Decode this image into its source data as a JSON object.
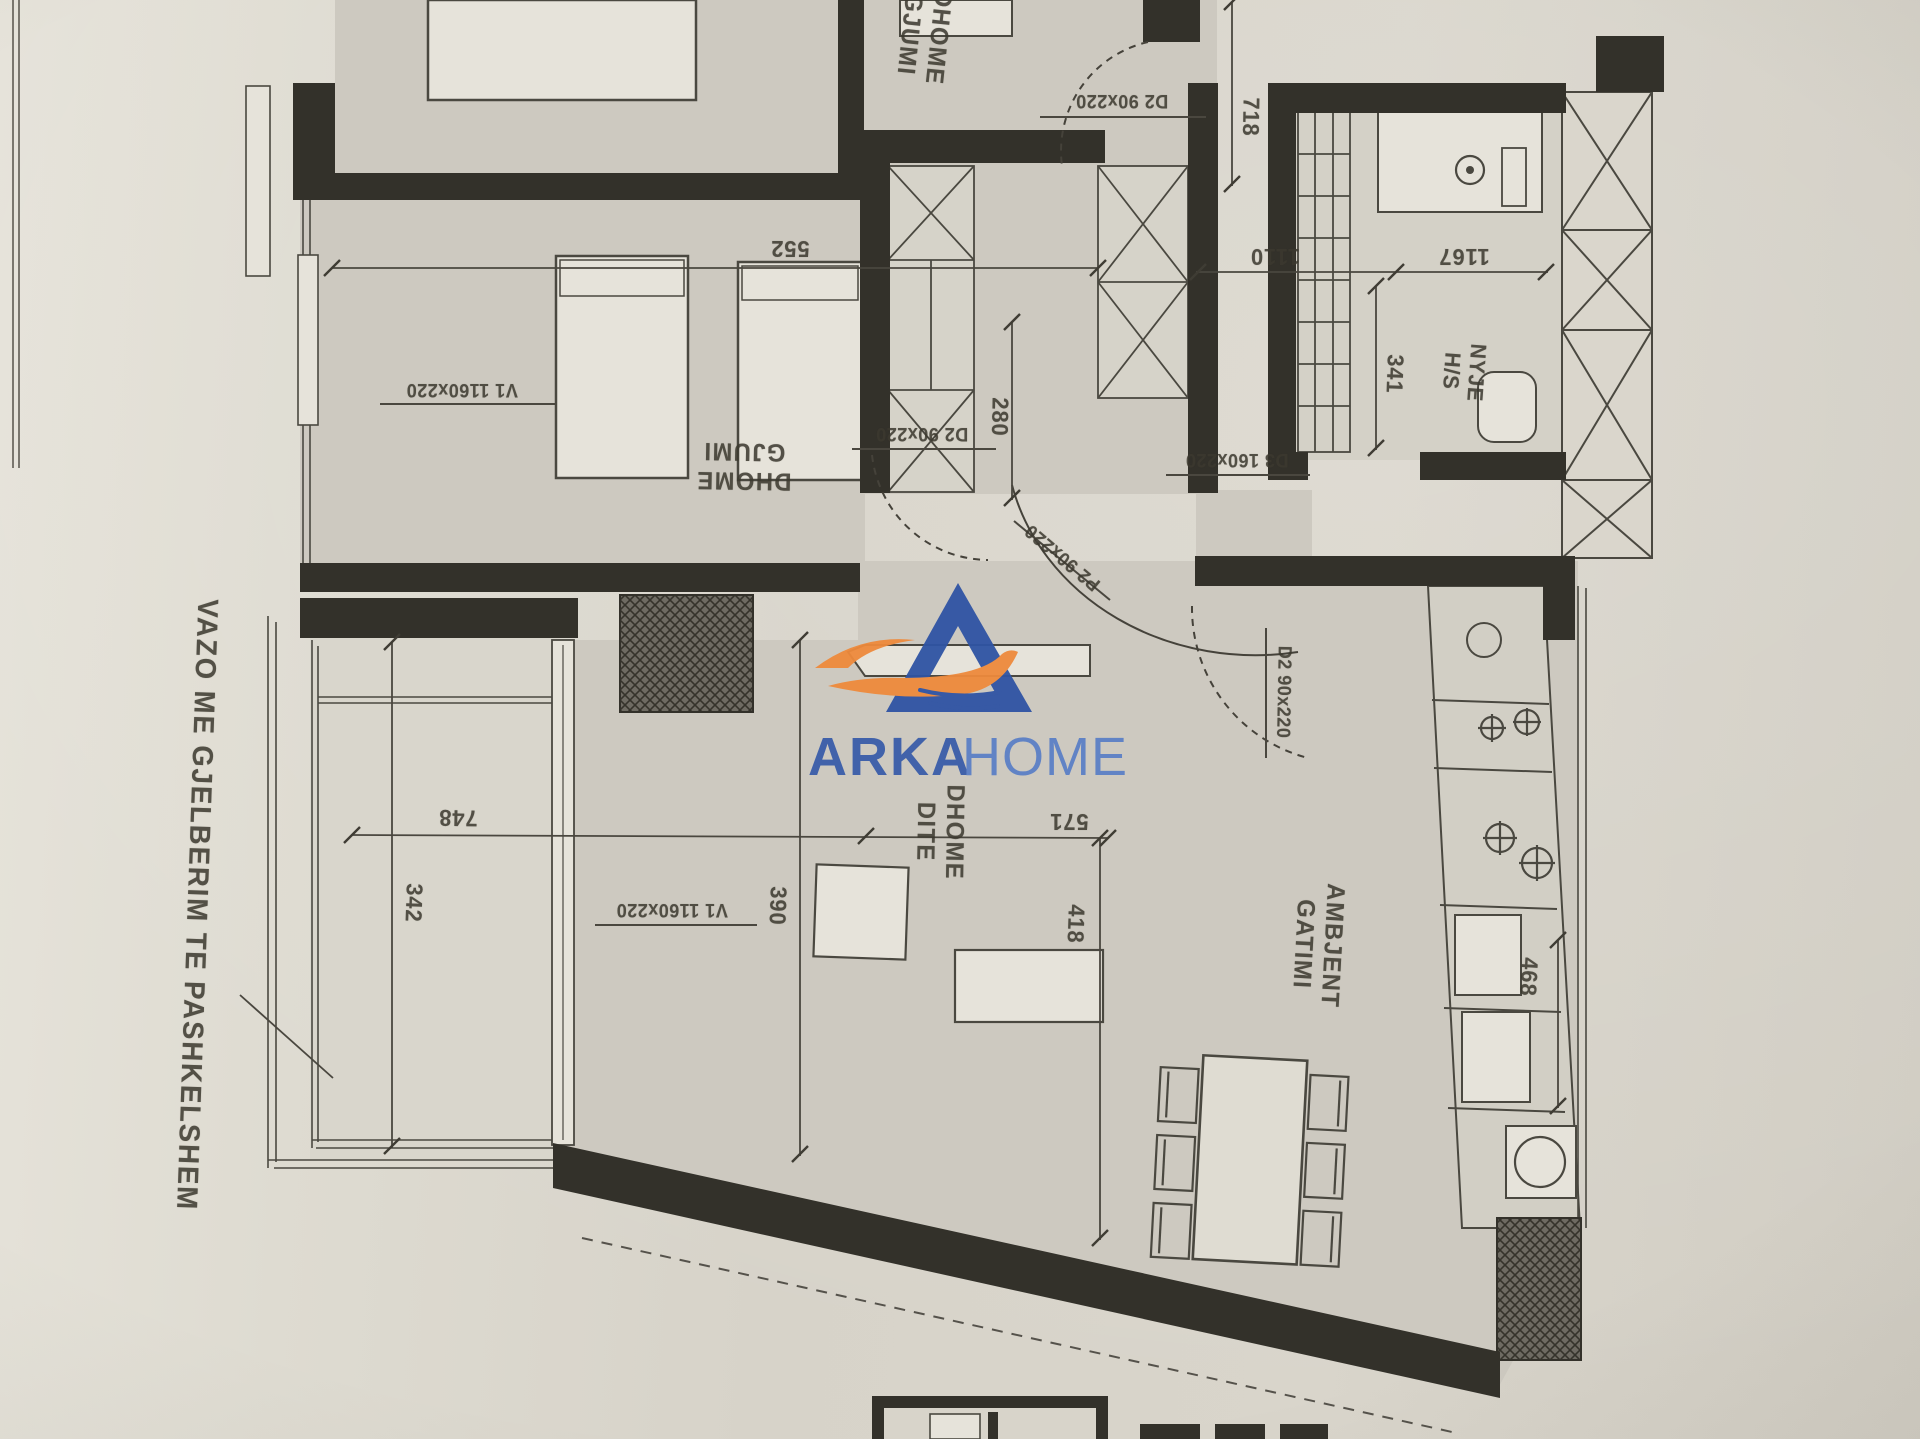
{
  "palette": {
    "ink": "#3c392f",
    "wall": "#33312a",
    "paper": "#dcd8ce"
  },
  "watermark": {
    "brand_primary": "ARKA",
    "brand_secondary": "HOME",
    "primary_color": "#3a5da9",
    "secondary_color": "#5c80c6",
    "triangle_color": "#2f54a4",
    "boat_color": "#ee8a3c",
    "wave_color": "#2f54a4",
    "logo_icon": "sailboat-in-letter-A"
  },
  "note": {
    "balcony_note": "VAZO ME GJELBERIM TE PASHKELSHEM"
  },
  "rooms": {
    "bedroom_top": {
      "line1": "DHOME",
      "line2": "GJUMI"
    },
    "bedroom_middle": {
      "line1": "DHOME",
      "line2": "GJUMI"
    },
    "living_room": {
      "line1": "DHOME",
      "line2": "DITE"
    },
    "kitchen": {
      "line1": "AMBJENT",
      "line2": "GATIMI"
    },
    "bathroom": {
      "line1": "NYJE",
      "line2": "H/S"
    }
  },
  "dimensions": {
    "bedroom_top_width": "552",
    "hall_height": "718",
    "corridor_width": "280",
    "hall_width": "1110",
    "bathroom_width": "1167",
    "bathroom_height": "341",
    "balcony_width": "748",
    "balcony_depth": "342",
    "living_left": "390",
    "living_width": "571",
    "living_right": "418",
    "kitchen_counter": "468"
  },
  "openings": {
    "door_bedroom_top": "D2 90x220",
    "door_bedroom_middle": "D2 90x220",
    "door_entry": "D3 160x220",
    "door_hall": "P2 90x220",
    "door_kitchen": "D2 90x220",
    "window_bedroom": "V1 1160x220",
    "window_living": "V1 1160x220"
  }
}
